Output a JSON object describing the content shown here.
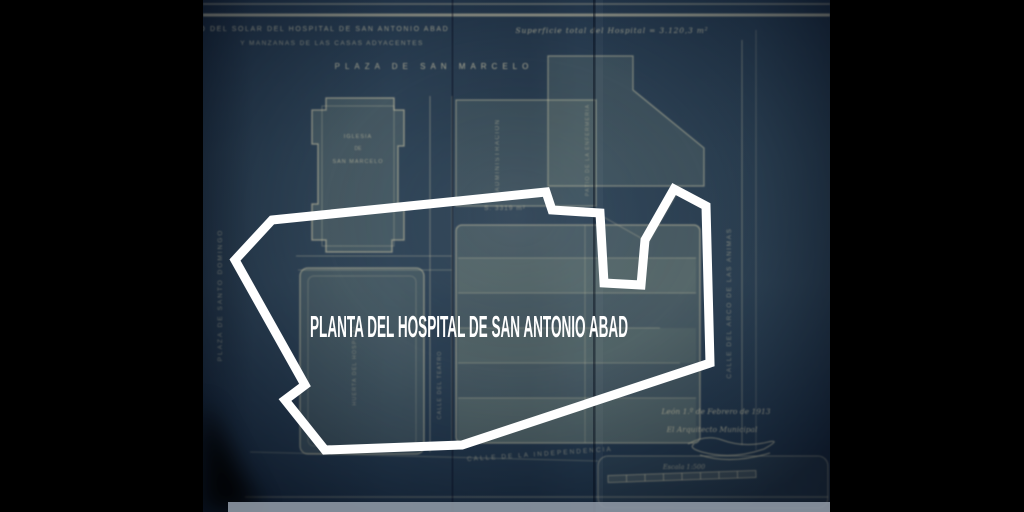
{
  "scene": {
    "bg_color": "#000000",
    "paper_color": "#2e4457",
    "line_color": "#d8cfab",
    "overlay_color": "#ffffff"
  },
  "overlay": {
    "title": "PLANTA DEL HOSPITAL DE SAN ANTONIO ABAD"
  },
  "header": {
    "title_line1": "PLANO DEL SOLAR DEL HOSPITAL DE SAN ANTONIO ABAD",
    "title_line2": "Y MANZANAS DE LAS CASAS ADYACENTES",
    "surface_note": "Superficie total del Hospital = 3.120,3 m²",
    "plaza_top": "PLAZA DE SAN MARCELO"
  },
  "streets": {
    "left_vertical": "PLAZA DE SANTO DOMINGO",
    "right_vertical": "CALLE DEL ARCO DE LAS ANIMAS",
    "mid_vertical": "CALLE DEL TEATRO",
    "bottom": "CALLE DE LA INDEPENDENCIA"
  },
  "blocks": {
    "church_line1": "IGLESIA",
    "church_line2": "DE",
    "church_line3": "SAN MARCELO",
    "admin_vertical": "ADMINISTRACION",
    "patio_vertical": "PATIO DE LA ENFERMERIA",
    "left_block_vertical": "HUERTA DEL HOSPITAL",
    "area_main": "S. 3319 m²",
    "area_annex": "S. 279 m²"
  },
  "footer": {
    "date_line": "León 1.º de Febrero de 1913",
    "architect_line": "El Arquitecto Municipal",
    "scale_label": "Escala 1:500"
  }
}
